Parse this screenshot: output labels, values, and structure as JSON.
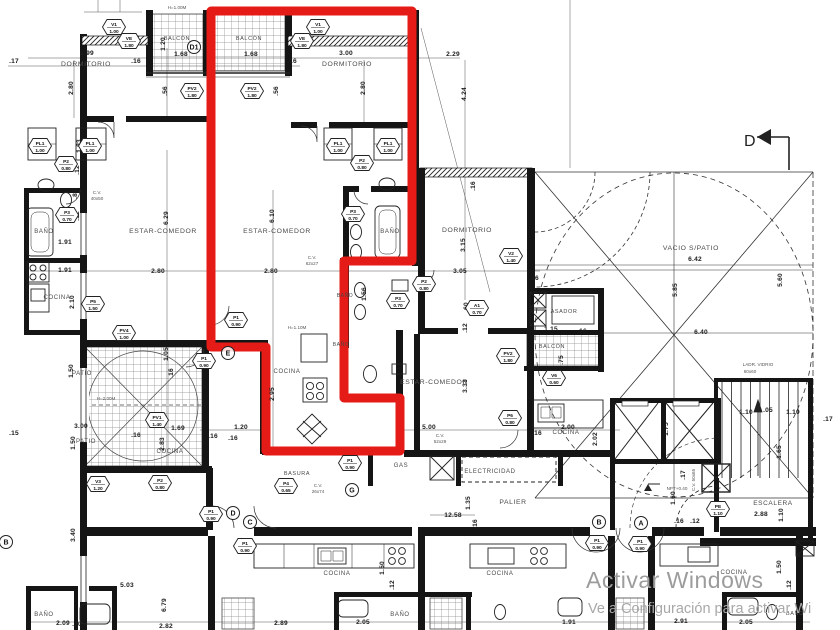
{
  "colors": {
    "red_outline": "#e41b17",
    "wall": "#151515",
    "watermark": "#9c9c9c",
    "watermark2": "#a8a8a8"
  },
  "watermark": {
    "line1": "Activar Windows",
    "line2": "Ve a Configuración para activar Wi"
  },
  "section_marker": {
    "label": "D"
  },
  "rooms": [
    {
      "t": "DORMITORIO",
      "x": 86,
      "y": 66
    },
    {
      "t": "BALCÓN",
      "x": 177,
      "y": 40,
      "s": 5.5
    },
    {
      "t": "BALCÓN",
      "x": 249,
      "y": 40,
      "s": 5.5
    },
    {
      "t": "DORMITORIO",
      "x": 347,
      "y": 66
    },
    {
      "t": "BAÑO",
      "x": 44,
      "y": 233,
      "s": 6
    },
    {
      "t": "ESTAR-COMEDOR",
      "x": 163,
      "y": 233
    },
    {
      "t": "ESTAR-COMEDOR",
      "x": 277,
      "y": 233
    },
    {
      "t": "BAÑO",
      "x": 390,
      "y": 233,
      "s": 6
    },
    {
      "t": "COCINA",
      "x": 57,
      "y": 299,
      "s": 6
    },
    {
      "t": "DORMITORIO",
      "x": 467,
      "y": 232
    },
    {
      "t": "BAÑO",
      "x": 345,
      "y": 297,
      "s": 5
    },
    {
      "t": "BAÑO",
      "x": 341,
      "y": 346,
      "s": 5
    },
    {
      "t": "VACIO S/PATIO",
      "x": 691,
      "y": 250
    },
    {
      "t": "ASADOR",
      "x": 564,
      "y": 313,
      "s": 5.5
    },
    {
      "t": "BALCÓN",
      "x": 552,
      "y": 348,
      "s": 5.5
    },
    {
      "t": "ESTAR-COMEDOR",
      "x": 434,
      "y": 384
    },
    {
      "t": "PATIO",
      "x": 82,
      "y": 375,
      "s": 6
    },
    {
      "t": "PATIO",
      "x": 86,
      "y": 443,
      "s": 6
    },
    {
      "t": "COCINA",
      "x": 287,
      "y": 373,
      "s": 6
    },
    {
      "t": "COCINA",
      "x": 170,
      "y": 453,
      "s": 6
    },
    {
      "t": "COCINA",
      "x": 566,
      "y": 434,
      "s": 6
    },
    {
      "t": "BASURA",
      "x": 297,
      "y": 475,
      "s": 5.5
    },
    {
      "t": "GAS",
      "x": 401,
      "y": 467,
      "s": 6
    },
    {
      "t": "ELECTRICIDAD",
      "x": 490,
      "y": 473,
      "s": 6
    },
    {
      "t": "PALIER",
      "x": 513,
      "y": 504
    },
    {
      "t": "ESCALERA",
      "x": 773,
      "y": 505,
      "s": 6.5
    },
    {
      "t": "COCINA",
      "x": 337,
      "y": 575,
      "s": 6
    },
    {
      "t": "COCINA",
      "x": 500,
      "y": 575,
      "s": 6
    },
    {
      "t": "COCINA",
      "x": 734,
      "y": 574,
      "s": 6
    },
    {
      "t": "BAÑO",
      "x": 44,
      "y": 616,
      "s": 6
    },
    {
      "t": "BAÑO",
      "x": 400,
      "y": 616,
      "s": 6
    },
    {
      "t": "BAÑO",
      "x": 795,
      "y": 615,
      "s": 5.5
    }
  ],
  "dims": [
    {
      "t": "2.99",
      "x": 87,
      "y": 55
    },
    {
      "t": ".17",
      "x": 14,
      "y": 63
    },
    {
      "t": ".16",
      "x": 136,
      "y": 63
    },
    {
      "t": "1.68",
      "x": 181,
      "y": 56
    },
    {
      "t": "1.68",
      "x": 251,
      "y": 56
    },
    {
      "t": "3.00",
      "x": 346,
      "y": 55
    },
    {
      "t": ".16",
      "x": 292,
      "y": 63
    },
    {
      "t": "2.29",
      "x": 453,
      "y": 56
    },
    {
      "t": "2.80",
      "x": 73,
      "y": 88,
      "r": 1
    },
    {
      "t": "2.80",
      "x": 365,
      "y": 88,
      "r": 1
    },
    {
      "t": "4.24",
      "x": 466,
      "y": 94,
      "r": 1
    },
    {
      "t": ".56",
      "x": 167,
      "y": 91,
      "r": 1
    },
    {
      "t": ".56",
      "x": 278,
      "y": 91,
      "r": 1
    },
    {
      "t": "1.83",
      "x": 81,
      "y": 146,
      "r": 1
    },
    {
      "t": ".12",
      "x": 79,
      "y": 170,
      "r": 1
    },
    {
      "t": ".80",
      "x": 77,
      "y": 194,
      "r": 1
    },
    {
      "t": ".12",
      "x": 79,
      "y": 216,
      "r": 1
    },
    {
      "t": "1.20",
      "x": 165,
      "y": 44,
      "r": 1
    },
    {
      "t": ".16",
      "x": 475,
      "y": 186,
      "r": 1
    },
    {
      "t": "6.29",
      "x": 168,
      "y": 218,
      "r": 1
    },
    {
      "t": "6.10",
      "x": 274,
      "y": 216,
      "r": 1
    },
    {
      "t": "1.91",
      "x": 65,
      "y": 244
    },
    {
      "t": "1.91",
      "x": 65,
      "y": 272
    },
    {
      "t": "2.80",
      "x": 158,
      "y": 273
    },
    {
      "t": "2.80",
      "x": 271,
      "y": 273
    },
    {
      "t": "2.10",
      "x": 74,
      "y": 302,
      "r": 1
    },
    {
      "t": "3.15",
      "x": 465,
      "y": 245,
      "r": 1
    },
    {
      "t": "3.05",
      "x": 460,
      "y": 273
    },
    {
      "t": ".16",
      "x": 534,
      "y": 280
    },
    {
      "t": "1.56",
      "x": 366,
      "y": 294,
      "r": 1
    },
    {
      "t": ".60",
      "x": 468,
      "y": 307,
      "r": 1
    },
    {
      "t": ".12",
      "x": 467,
      "y": 328,
      "r": 1
    },
    {
      "t": "6.42",
      "x": 695,
      "y": 261
    },
    {
      "t": "6.40",
      "x": 701,
      "y": 334
    },
    {
      "t": "5.85",
      "x": 677,
      "y": 290,
      "r": 1
    },
    {
      "t": "5.60",
      "x": 782,
      "y": 280,
      "r": 1
    },
    {
      "t": "1.15",
      "x": 551,
      "y": 331
    },
    {
      "t": ".16",
      "x": 582,
      "y": 333
    },
    {
      "t": ".75",
      "x": 563,
      "y": 360,
      "r": 1
    },
    {
      "t": "1.05",
      "x": 168,
      "y": 354,
      "r": 1
    },
    {
      "t": ".16",
      "x": 173,
      "y": 373,
      "r": 1
    },
    {
      "t": "1.50",
      "x": 73,
      "y": 371,
      "r": 1
    },
    {
      "t": "3.00",
      "x": 81,
      "y": 428
    },
    {
      "t": "1.50",
      "x": 75,
      "y": 443,
      "r": 1
    },
    {
      "t": ".15",
      "x": 14,
      "y": 435
    },
    {
      "t": ".16",
      "x": 136,
      "y": 437
    },
    {
      "t": "1.69",
      "x": 178,
      "y": 430
    },
    {
      "t": "2.83",
      "x": 164,
      "y": 444,
      "r": 1
    },
    {
      "t": "2.95",
      "x": 274,
      "y": 394,
      "r": 1
    },
    {
      "t": "1.20",
      "x": 241,
      "y": 429
    },
    {
      "t": ".16",
      "x": 213,
      "y": 438
    },
    {
      "t": ".16",
      "x": 233,
      "y": 440
    },
    {
      "t": "3.33",
      "x": 467,
      "y": 386,
      "r": 1
    },
    {
      "t": "5.00",
      "x": 429,
      "y": 429
    },
    {
      "t": "2.00",
      "x": 568,
      "y": 429
    },
    {
      "t": "2.02",
      "x": 597,
      "y": 439,
      "r": 1
    },
    {
      "t": ".16",
      "x": 537,
      "y": 435
    },
    {
      "t": "12.58",
      "x": 453,
      "y": 517
    },
    {
      "t": "1.35",
      "x": 470,
      "y": 503,
      "r": 1
    },
    {
      "t": ".16",
      "x": 477,
      "y": 524,
      "r": 1
    },
    {
      "t": "1.75",
      "x": 668,
      "y": 429,
      "r": 1
    },
    {
      "t": "1.10",
      "x": 746,
      "y": 414
    },
    {
      "t": ".05",
      "x": 768,
      "y": 412
    },
    {
      "t": "1.10",
      "x": 793,
      "y": 414
    },
    {
      "t": ".17",
      "x": 828,
      "y": 421
    },
    {
      "t": "1.65",
      "x": 781,
      "y": 452,
      "r": 1
    },
    {
      "t": "1.10",
      "x": 783,
      "y": 515,
      "r": 1
    },
    {
      "t": "2.88",
      "x": 761,
      "y": 516
    },
    {
      "t": "1.60",
      "x": 675,
      "y": 498,
      "r": 1
    },
    {
      "t": ".17",
      "x": 685,
      "y": 475,
      "r": 1
    },
    {
      "t": ".16",
      "x": 679,
      "y": 523
    },
    {
      "t": ".12",
      "x": 695,
      "y": 523
    },
    {
      "t": "3.40",
      "x": 75,
      "y": 535,
      "r": 1
    },
    {
      "t": "5.03",
      "x": 127,
      "y": 587
    },
    {
      "t": "6.79",
      "x": 166,
      "y": 605,
      "r": 1
    },
    {
      "t": "2.82",
      "x": 166,
      "y": 628
    },
    {
      "t": "2.09",
      "x": 63,
      "y": 625
    },
    {
      "t": ".20",
      "x": 77,
      "y": 626
    },
    {
      "t": "2.89",
      "x": 281,
      "y": 625
    },
    {
      "t": "2.05",
      "x": 363,
      "y": 624
    },
    {
      "t": "1.50",
      "x": 384,
      "y": 568,
      "r": 1
    },
    {
      "t": ".12",
      "x": 394,
      "y": 585,
      "r": 1
    },
    {
      "t": "1.91",
      "x": 569,
      "y": 624
    },
    {
      "t": "2.91",
      "x": 681,
      "y": 623
    },
    {
      "t": "2.05",
      "x": 746,
      "y": 624
    },
    {
      "t": "1.50",
      "x": 781,
      "y": 567,
      "r": 1
    },
    {
      "t": ".12",
      "x": 791,
      "y": 585,
      "r": 1
    }
  ],
  "tags": [
    {
      "c": "V1",
      "v": "1.00",
      "x": 114,
      "y": 27
    },
    {
      "c": "VE",
      "v": "1.80",
      "x": 129,
      "y": 41
    },
    {
      "c": "V1",
      "v": "1.00",
      "x": 318,
      "y": 27
    },
    {
      "c": "VE",
      "v": "1.80",
      "x": 302,
      "y": 41
    },
    {
      "c": "PV2",
      "v": "1.80",
      "x": 192,
      "y": 91
    },
    {
      "c": "PV2",
      "v": "1.80",
      "x": 252,
      "y": 91
    },
    {
      "c": "PL1",
      "v": "1.00",
      "x": 40,
      "y": 146
    },
    {
      "c": "PL1",
      "v": "1.00",
      "x": 90,
      "y": 146
    },
    {
      "c": "P2",
      "v": "0.80",
      "x": 66,
      "y": 164
    },
    {
      "c": "P3",
      "v": "0.70",
      "x": 67,
      "y": 215
    },
    {
      "c": "PL1",
      "v": "1.00",
      "x": 338,
      "y": 146
    },
    {
      "c": "PL1",
      "v": "1.00",
      "x": 388,
      "y": 146
    },
    {
      "c": "P2",
      "v": "0.80",
      "x": 362,
      "y": 163
    },
    {
      "c": "P3",
      "v": "0.70",
      "x": 353,
      "y": 214
    },
    {
      "c": "P1",
      "v": "0.90",
      "x": 236,
      "y": 320
    },
    {
      "c": "P1",
      "v": "0.90",
      "x": 204,
      "y": 361
    },
    {
      "c": "P2",
      "v": "0.80",
      "x": 424,
      "y": 284
    },
    {
      "c": "P3",
      "v": "0.70",
      "x": 398,
      "y": 301
    },
    {
      "c": "V2",
      "v": "1.40",
      "x": 511,
      "y": 256
    },
    {
      "c": "A1",
      "v": "0.70",
      "x": 477,
      "y": 308
    },
    {
      "c": "PV2",
      "v": "1.80",
      "x": 508,
      "y": 356
    },
    {
      "c": "V6",
      "v": "0.60",
      "x": 554,
      "y": 378
    },
    {
      "c": "P5",
      "v": "1.50",
      "x": 93,
      "y": 304
    },
    {
      "c": "PV4",
      "v": "1.00",
      "x": 124,
      "y": 333
    },
    {
      "c": "PV1",
      "v": "1.40",
      "x": 157,
      "y": 420
    },
    {
      "c": "P2",
      "v": "0.80",
      "x": 160,
      "y": 483
    },
    {
      "c": "V3",
      "v": "1.20",
      "x": 98,
      "y": 484
    },
    {
      "c": "P1",
      "v": "0.90",
      "x": 211,
      "y": 514
    },
    {
      "c": "P1",
      "v": "0.90",
      "x": 245,
      "y": 546
    },
    {
      "c": "P4",
      "v": "0.65",
      "x": 286,
      "y": 486
    },
    {
      "c": "P1",
      "v": "0.90",
      "x": 350,
      "y": 463
    },
    {
      "c": "P6",
      "v": "0.80",
      "x": 510,
      "y": 418
    },
    {
      "c": "P1",
      "v": "0.90",
      "x": 597,
      "y": 543
    },
    {
      "c": "P1",
      "v": "0.90",
      "x": 640,
      "y": 544
    },
    {
      "c": "PE",
      "v": "1.10",
      "x": 718,
      "y": 509
    }
  ],
  "markers": [
    {
      "t": "D1",
      "x": 194,
      "y": 47
    },
    {
      "t": "E",
      "x": 228,
      "y": 353
    },
    {
      "t": "G",
      "x": 352,
      "y": 490
    },
    {
      "t": "D",
      "x": 233,
      "y": 513
    },
    {
      "t": "C",
      "x": 250,
      "y": 522
    },
    {
      "t": "B",
      "x": 599,
      "y": 522
    },
    {
      "t": "A",
      "x": 641,
      "y": 523
    },
    {
      "t": "B",
      "x": 6,
      "y": 542
    }
  ],
  "notes": [
    {
      "t": "H=1.00M",
      "x": 177,
      "y": 9
    },
    {
      "t": "C.V.",
      "x": 97,
      "y": 194
    },
    {
      "t": "40x50",
      "x": 97,
      "y": 200
    },
    {
      "t": "C.V.",
      "x": 312,
      "y": 259
    },
    {
      "t": "62x27",
      "x": 312,
      "y": 265
    },
    {
      "t": "H=1.10M",
      "x": 297,
      "y": 329
    },
    {
      "t": "H=2.00M",
      "x": 106,
      "y": 400
    },
    {
      "t": "C.V.",
      "x": 440,
      "y": 437
    },
    {
      "t": "52x29",
      "x": 440,
      "y": 443
    },
    {
      "t": "C.V.",
      "x": 318,
      "y": 487
    },
    {
      "t": "26x74",
      "x": 318,
      "y": 493
    },
    {
      "t": "C.V. 50x65",
      "x": 695,
      "y": 480,
      "r": 1
    },
    {
      "t": "LADR. VIDRIO",
      "x": 758,
      "y": 366
    },
    {
      "t": "60x60",
      "x": 750,
      "y": 373
    },
    {
      "t": "NPT+0.40",
      "x": 677,
      "y": 490
    }
  ]
}
